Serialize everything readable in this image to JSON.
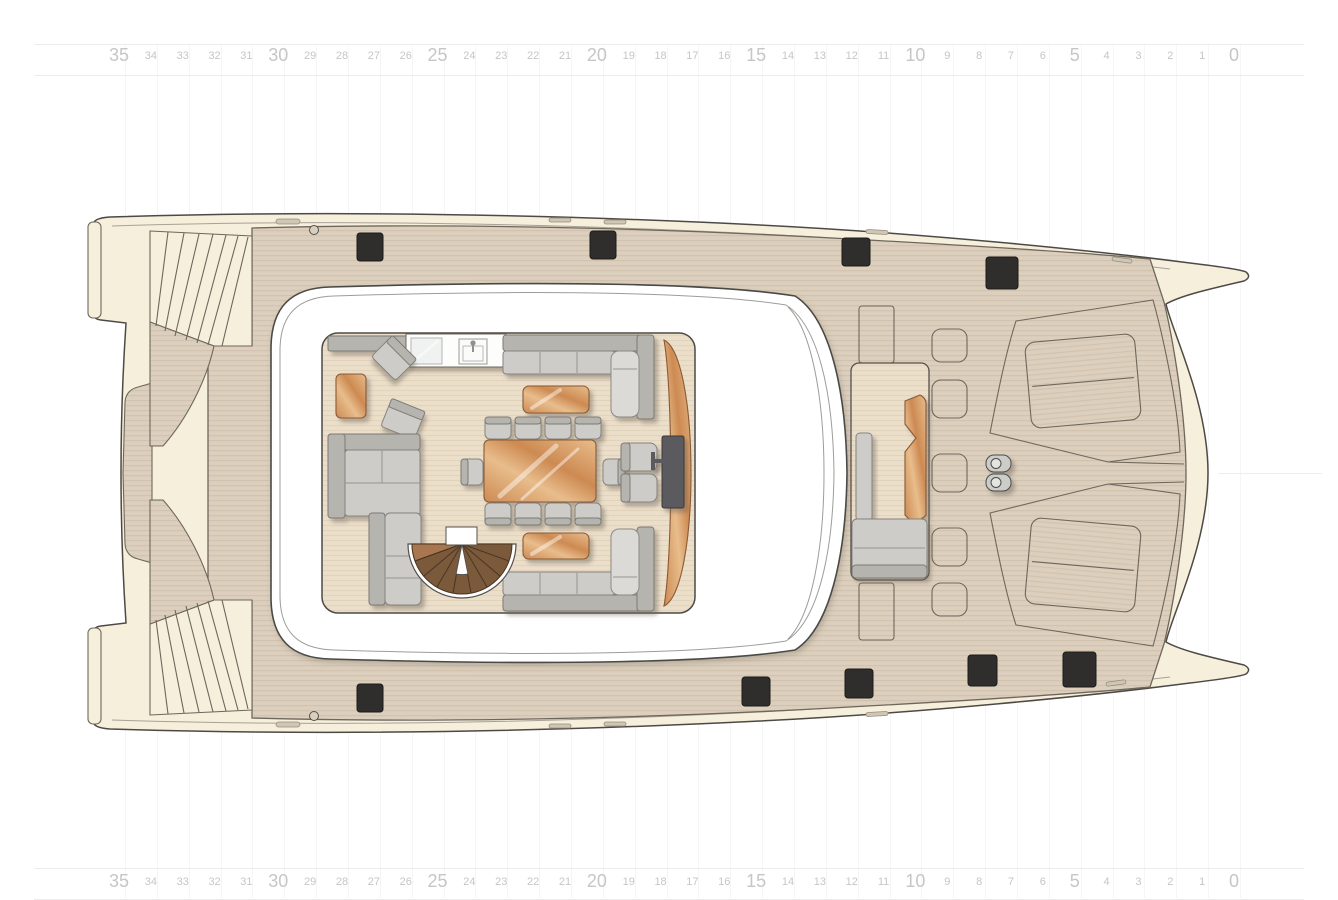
{
  "ruler": {
    "labels": [
      "35",
      "34",
      "33",
      "32",
      "31",
      "30",
      "29",
      "28",
      "27",
      "26",
      "25",
      "24",
      "23",
      "22",
      "21",
      "20",
      "19",
      "18",
      "17",
      "16",
      "15",
      "14",
      "13",
      "12",
      "11",
      "10",
      "9",
      "8",
      "7",
      "6",
      "5",
      "4",
      "3",
      "2",
      "1",
      "0"
    ],
    "major_every": 5,
    "min": 0,
    "max": 35
  },
  "colors": {
    "hull_cream": "#f6efdc",
    "deck_tan": "#dccfbd",
    "deck_line": "#d2c3ae",
    "floor_tan": "#ecdfca",
    "floor_line": "#e2d3bc",
    "outline": "#4d4a45",
    "mid_outline": "#6f675c",
    "roof_white": "#ffffff",
    "furniture_gray": "#cdccc8",
    "furniture_gray_dark": "#b6b4af",
    "furniture_gray_light": "#dbdad6",
    "wood": "#cd8a52",
    "wood_light": "#e8bd8c",
    "wood_dark": "#8a5a36",
    "stair_wood": "#7a5a3a",
    "stair_wood_dark": "#4a3524",
    "hatch_black": "#2f2e2c",
    "ruler_text": "#c6c6c6",
    "grid_line": "#ececec"
  },
  "plan": {
    "type": "catamaran-main-deck-plan",
    "counts": {
      "dining_chairs": 10,
      "deck_hatches_black": 9,
      "foredeck_lockers": 5,
      "sun_lounger_panels": 2,
      "stern_staircases": 2,
      "bollards": 2
    },
    "features": [
      "stern-platform",
      "swim-platform",
      "stern-stairs-port",
      "stern-stairs-starboard",
      "aft-deck",
      "coachroof",
      "salon",
      "galley-counter",
      "cooktop",
      "sink",
      "lounge-armchairs",
      "sofas",
      "coffee-tables",
      "dining-table",
      "dining-chairs",
      "spiral-staircase",
      "tv-cabinet",
      "tv-seats",
      "forward-cockpit",
      "cockpit-table",
      "cockpit-bench",
      "cockpit-sunpad",
      "foredeck-lockers",
      "bollards",
      "sun-loungers",
      "anchor-channel",
      "bow-port",
      "bow-starboard"
    ]
  }
}
